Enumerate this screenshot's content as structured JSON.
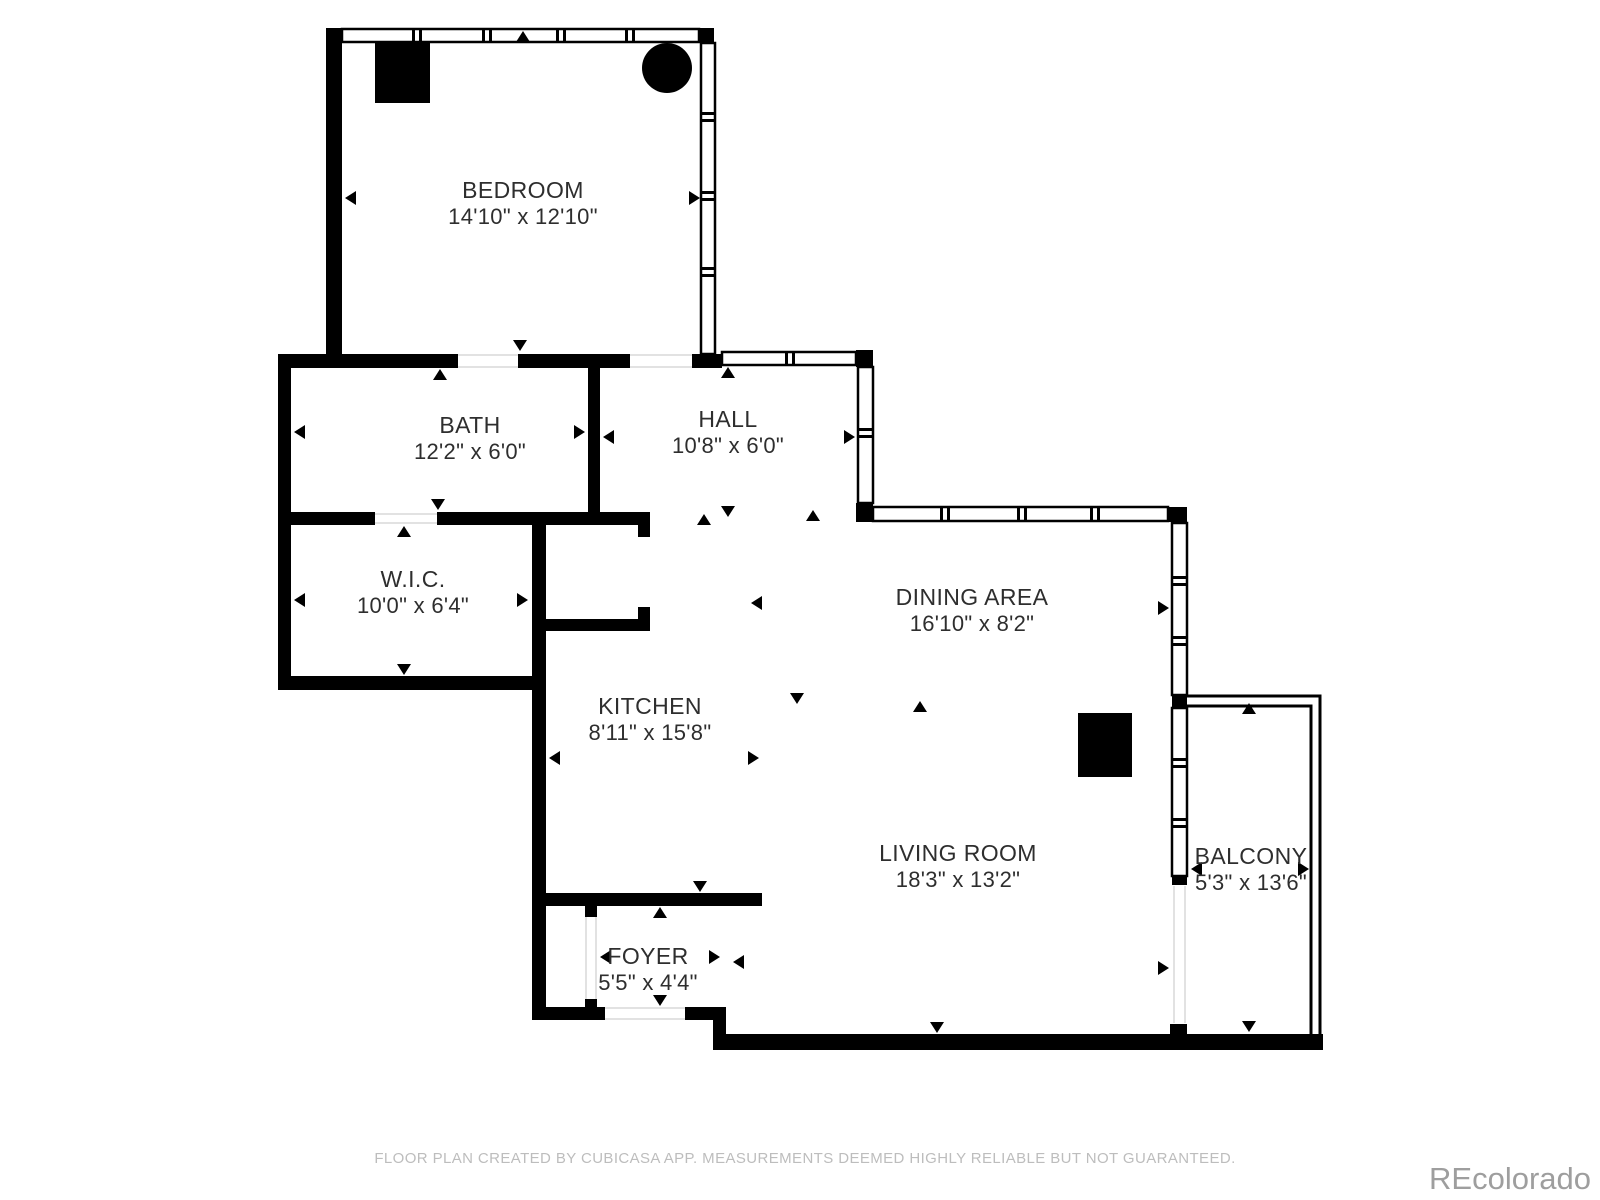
{
  "page": {
    "background": "#ffffff"
  },
  "colors": {
    "wall": "#000000",
    "label_text": "#2e2e2e",
    "disclaimer_text": "#bdbdbd",
    "watermark_text": "#9e9e9e"
  },
  "rooms": [
    {
      "name": "BEDROOM",
      "dims": "14'10\" x 12'10\""
    },
    {
      "name": "BATH",
      "dims": "12'2\" x 6'0\""
    },
    {
      "name": "W.I.C.",
      "dims": "10'0\" x 6'4\""
    },
    {
      "name": "HALL",
      "dims": "10'8\" x 6'0\""
    },
    {
      "name": "DINING AREA",
      "dims": "16'10\" x 8'2\""
    },
    {
      "name": "KITCHEN",
      "dims": "8'11\" x 15'8\""
    },
    {
      "name": "LIVING ROOM",
      "dims": "18'3\" x 13'2\""
    },
    {
      "name": "FOYER",
      "dims": "5'5\" x 4'4\""
    },
    {
      "name": "BALCONY",
      "dims": "5'3\" x 13'6\""
    }
  ],
  "footer": {
    "disclaimer": "FLOOR PLAN CREATED BY CUBICASA APP. MEASUREMENTS DEEMED HIGHLY RELIABLE BUT NOT GUARANTEED.",
    "watermark": "REcolorado"
  }
}
